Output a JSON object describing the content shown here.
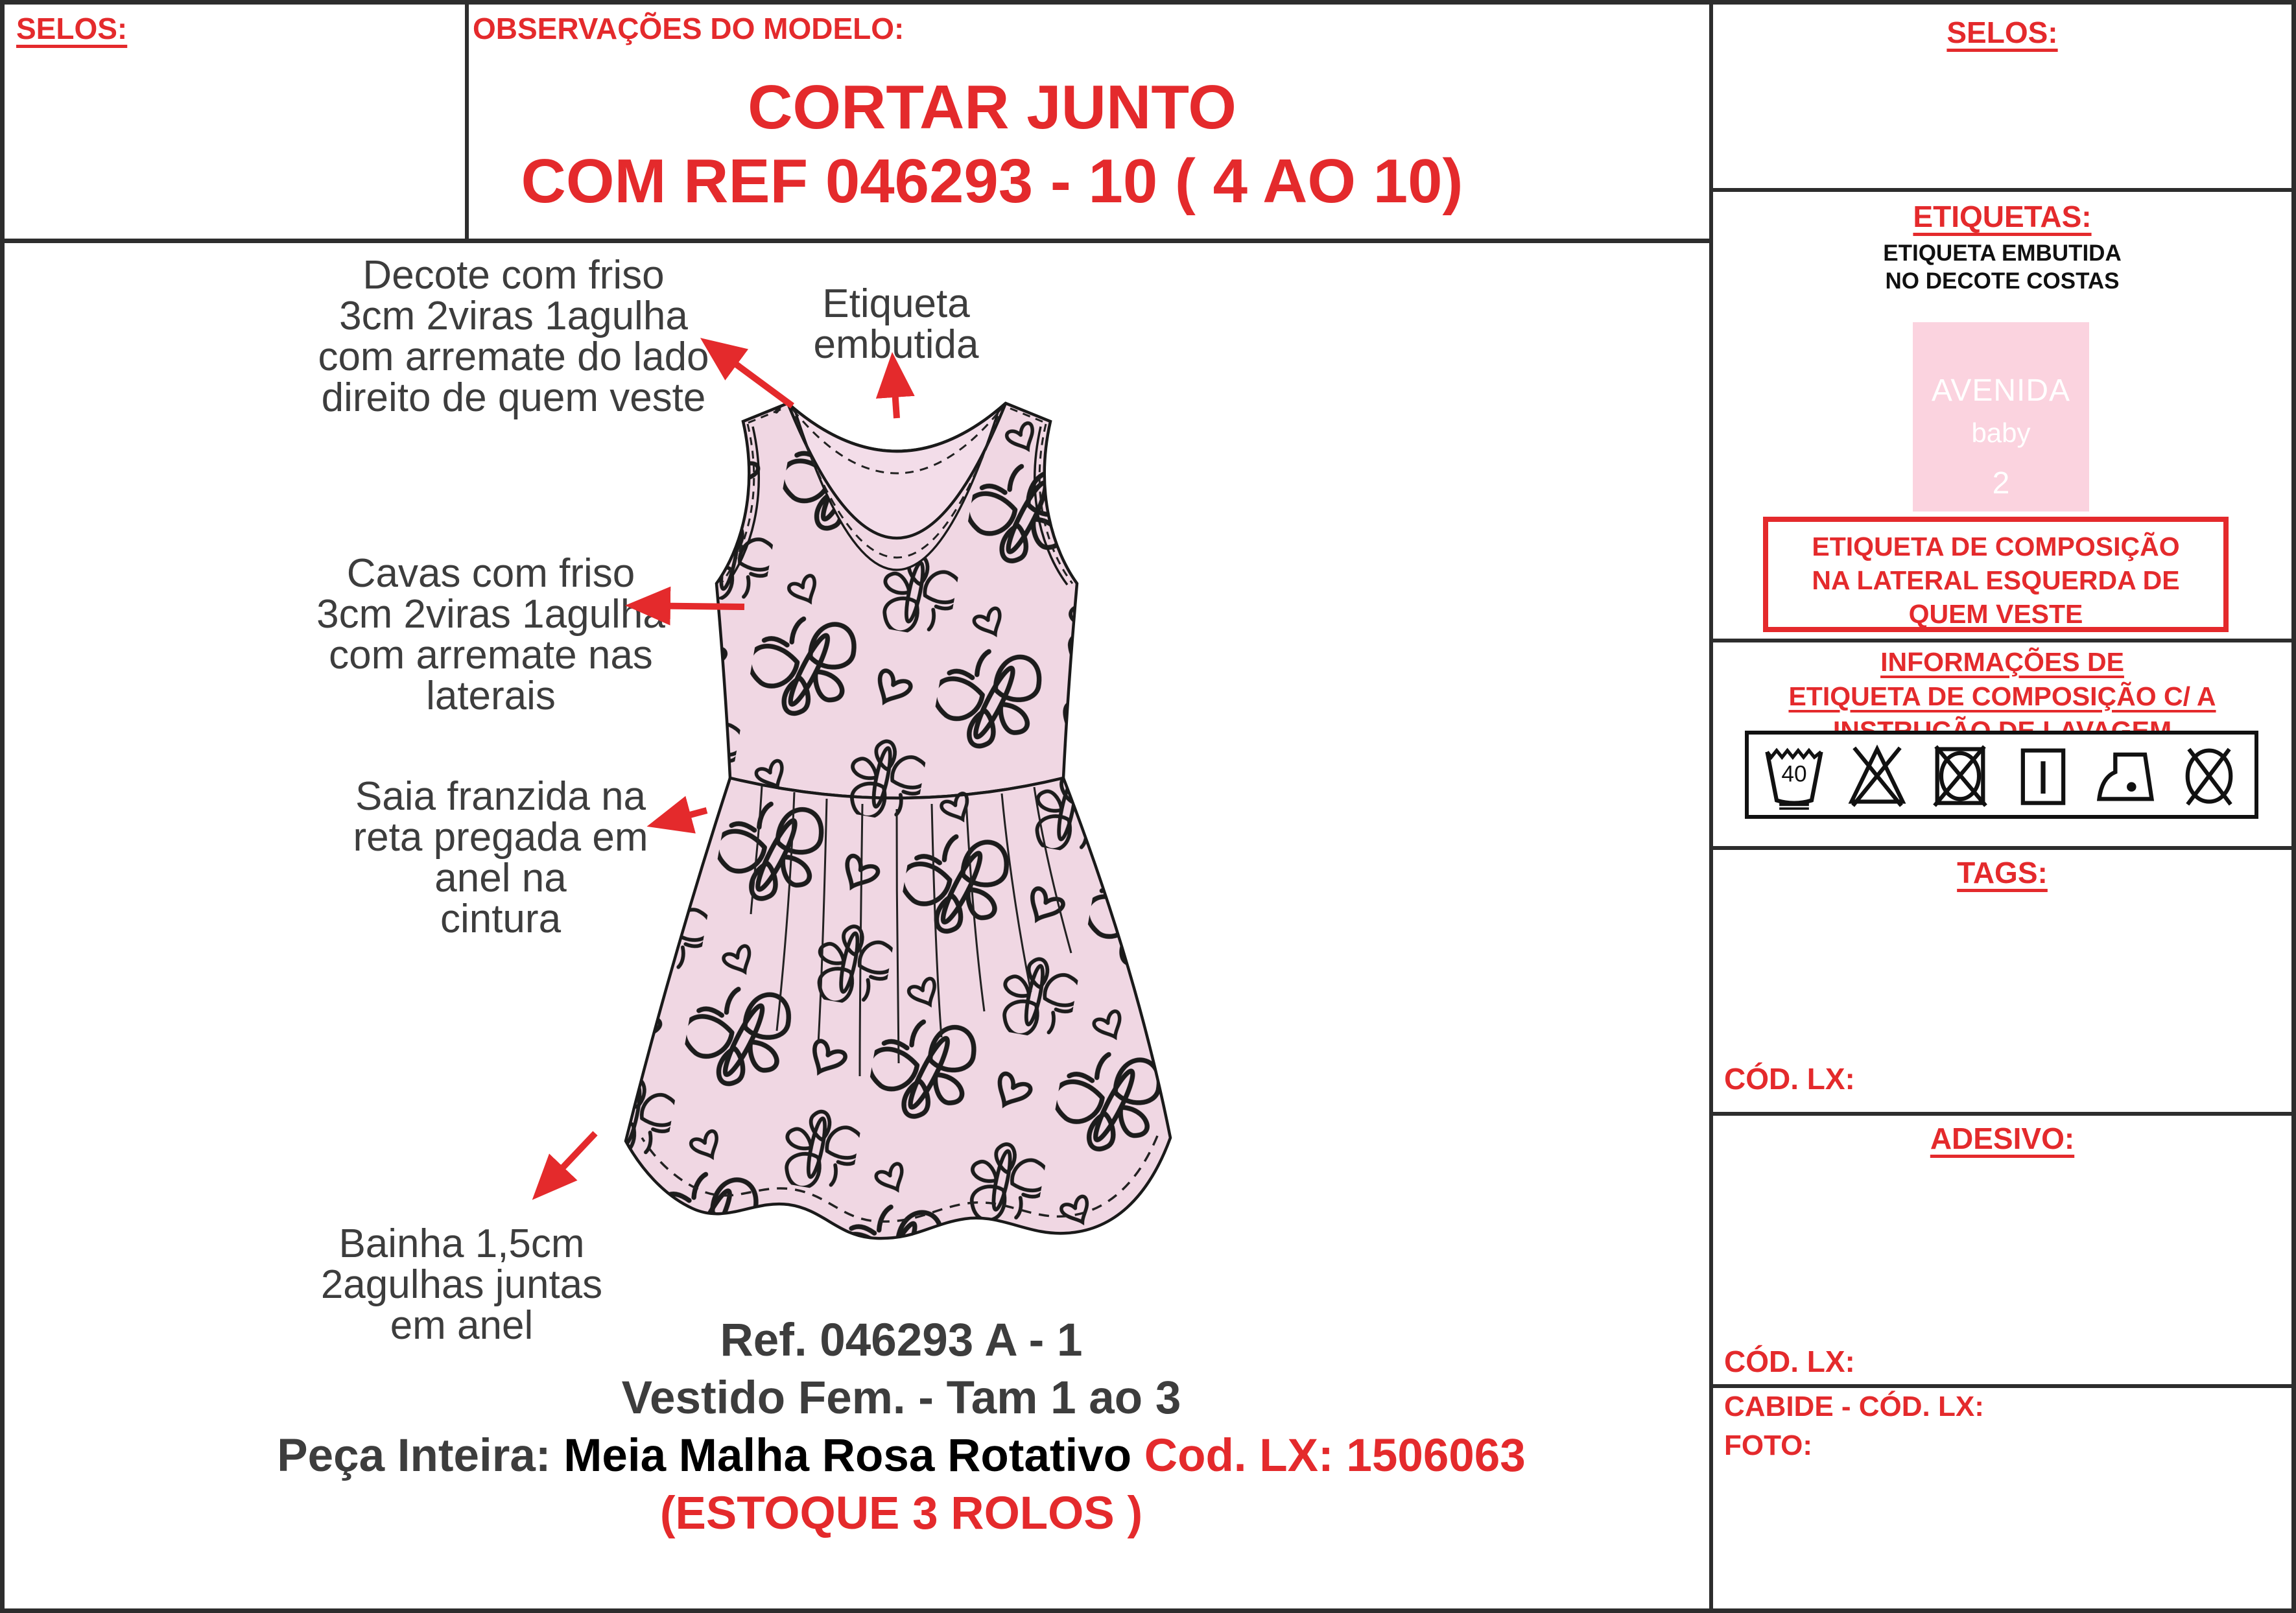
{
  "header": {
    "selos_left": "SELOS:",
    "observacoes": "OBSERVAÇÕES DO MODELO:",
    "title1": "CORTAR JUNTO",
    "title2": "COM REF 046293 - 10 ( 4 AO 10)"
  },
  "annotations": {
    "decote": [
      "Decote com friso",
      "3cm 2viras 1agulha",
      "com arremate do lado",
      "direito de quem veste"
    ],
    "etiqueta": [
      "Etiqueta",
      "embutida"
    ],
    "cavas": [
      "Cavas com friso",
      "3cm 2viras 1agulha",
      "com arremate nas",
      "laterais"
    ],
    "saia": [
      "Saia franzida na",
      "reta pregada em",
      "anel na",
      "cintura"
    ],
    "bainha": [
      "Bainha 1,5cm",
      "2agulhas juntas",
      "em anel"
    ]
  },
  "footer": {
    "ref": "Ref. 046293 A - 1",
    "descricao": "Vestido Fem.  - Tam 1 ao 3",
    "peca_label": "Peça Inteira: ",
    "peca_material": "Meia Malha Rosa Rotativo ",
    "peca_cod": "Cod. LX: 1506063",
    "estoque": "(ESTOQUE 3 ROLOS )"
  },
  "sidebar": {
    "selos_title": "SELOS:",
    "etiquetas_title": "ETIQUETAS:",
    "etiqueta_sub1": "ETIQUETA EMBUTIDA",
    "etiqueta_sub2": "NO DECOTE COSTAS",
    "brand_label": {
      "line1": "AVENIDA",
      "line2": "baby",
      "line3": "2"
    },
    "comp_box": [
      "ETIQUETA DE COMPOSIÇÃO",
      "NA LATERAL ESQUERDA DE",
      "QUEM VESTE"
    ],
    "info_title": [
      "INFORMAÇÕES DE",
      "ETIQUETA DE COMPOSIÇÃO C/ A",
      "INSTRUÇÃO DE LAVAGEM"
    ],
    "care": {
      "wash_temp": "40",
      "symbols": [
        "wash-40-very-gentle",
        "do-not-bleach",
        "do-not-tumble-dry",
        "line-dry",
        "iron-low-heat",
        "do-not-dry-clean"
      ]
    },
    "tags_title": "TAGS:",
    "tags_cod": "CÓD. LX:",
    "adesivo_title": "ADESIVO:",
    "adesivo_cod": "CÓD. LX:",
    "cabide_label": "CABIDE - CÓD. LX:",
    "foto_label": "FOTO:"
  },
  "colors": {
    "red": "#e42a2c",
    "text_gray": "#3d3d3d",
    "fabric_pink": "#f0d7e3",
    "label_pink": "#fbd3df",
    "border_dark": "#2d2d2d"
  }
}
